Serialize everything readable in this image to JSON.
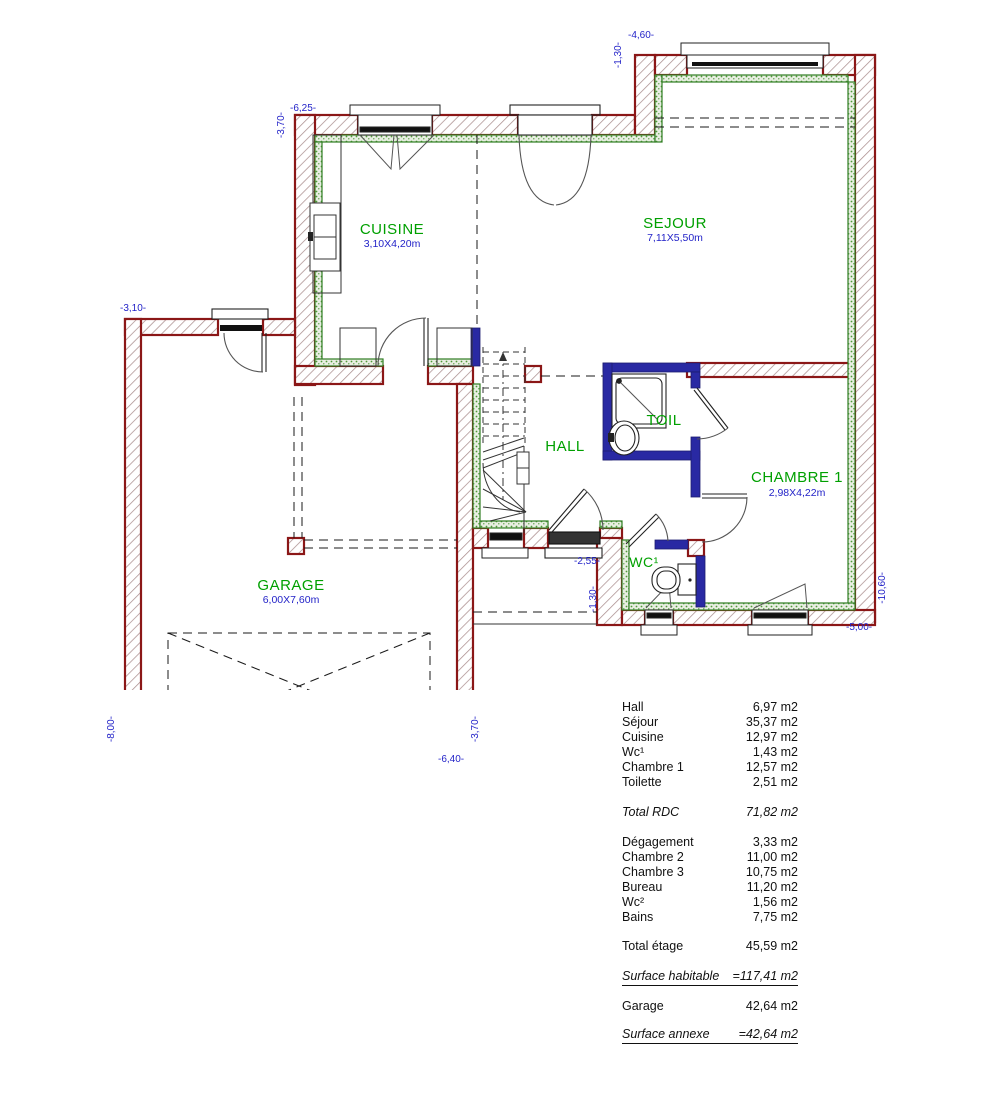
{
  "plan": {
    "colors": {
      "wall_red": "#8b1717",
      "insulation_green": "#2f7d22",
      "partition_blue": "#2929a3",
      "room_label_green": "#00a000",
      "dimension_blue": "#2323c8"
    },
    "rooms": {
      "cuisine": {
        "label": "CUISINE",
        "size": "3,10X4,20m"
      },
      "sejour": {
        "label": "SEJOUR",
        "size": "7,11X5,50m"
      },
      "hall": {
        "label": "HALL"
      },
      "toil": {
        "label": "TOIL"
      },
      "chambre1": {
        "label": "CHAMBRE 1",
        "size": "2,98X4,22m"
      },
      "wc": {
        "label": "WC¹"
      },
      "garage": {
        "label": "GARAGE",
        "size": "6,00X7,60m"
      }
    },
    "dims": {
      "cuisine_top_w": "-6,25-",
      "cuisine_left_h": "-3,70-",
      "sejour_top_w": "-4,60-",
      "sejour_step_h": "-1,30-",
      "garage_top_w": "-3,10-",
      "garage_left_h": "-8,00-",
      "garage_bottom_w": "-6,40-",
      "garage_right_h": "-3,70-",
      "wc_step_w": "-2,55-",
      "wc_step_h": "-1,30-",
      "chambre_bottom_w": "-5,00-",
      "house_right_h": "-10,60-"
    }
  },
  "areas": {
    "rdc_rows": [
      {
        "label": "Hall",
        "value": "6,97 m2"
      },
      {
        "label": "Séjour",
        "value": "35,37 m2"
      },
      {
        "label": "Cuisine",
        "value": "12,97 m2"
      },
      {
        "label": "Wc¹",
        "value": "1,43 m2"
      },
      {
        "label": "Chambre 1",
        "value": "12,57 m2"
      },
      {
        "label": "Toilette",
        "value": "2,51 m2"
      }
    ],
    "total_rdc": {
      "label": "Total RDC",
      "value": "71,82 m2"
    },
    "etage_rows": [
      {
        "label": "Dégagement",
        "value": "3,33 m2"
      },
      {
        "label": "Chambre 2",
        "value": "11,00 m2"
      },
      {
        "label": "Chambre 3",
        "value": "10,75 m2"
      },
      {
        "label": "Bureau",
        "value": "11,20 m2"
      },
      {
        "label": "Wc²",
        "value": "1,56 m2"
      },
      {
        "label": "Bains",
        "value": "7,75 m2"
      }
    ],
    "total_etage": {
      "label": "Total étage",
      "value": "45,59 m2"
    },
    "surface_habitable": {
      "label": "Surface habitable",
      "value": "=117,41 m2"
    },
    "garage_row": {
      "label": "Garage",
      "value": "42,64 m2"
    },
    "surface_annexe": {
      "label": "Surface annexe",
      "value": "=42,64 m2"
    }
  }
}
